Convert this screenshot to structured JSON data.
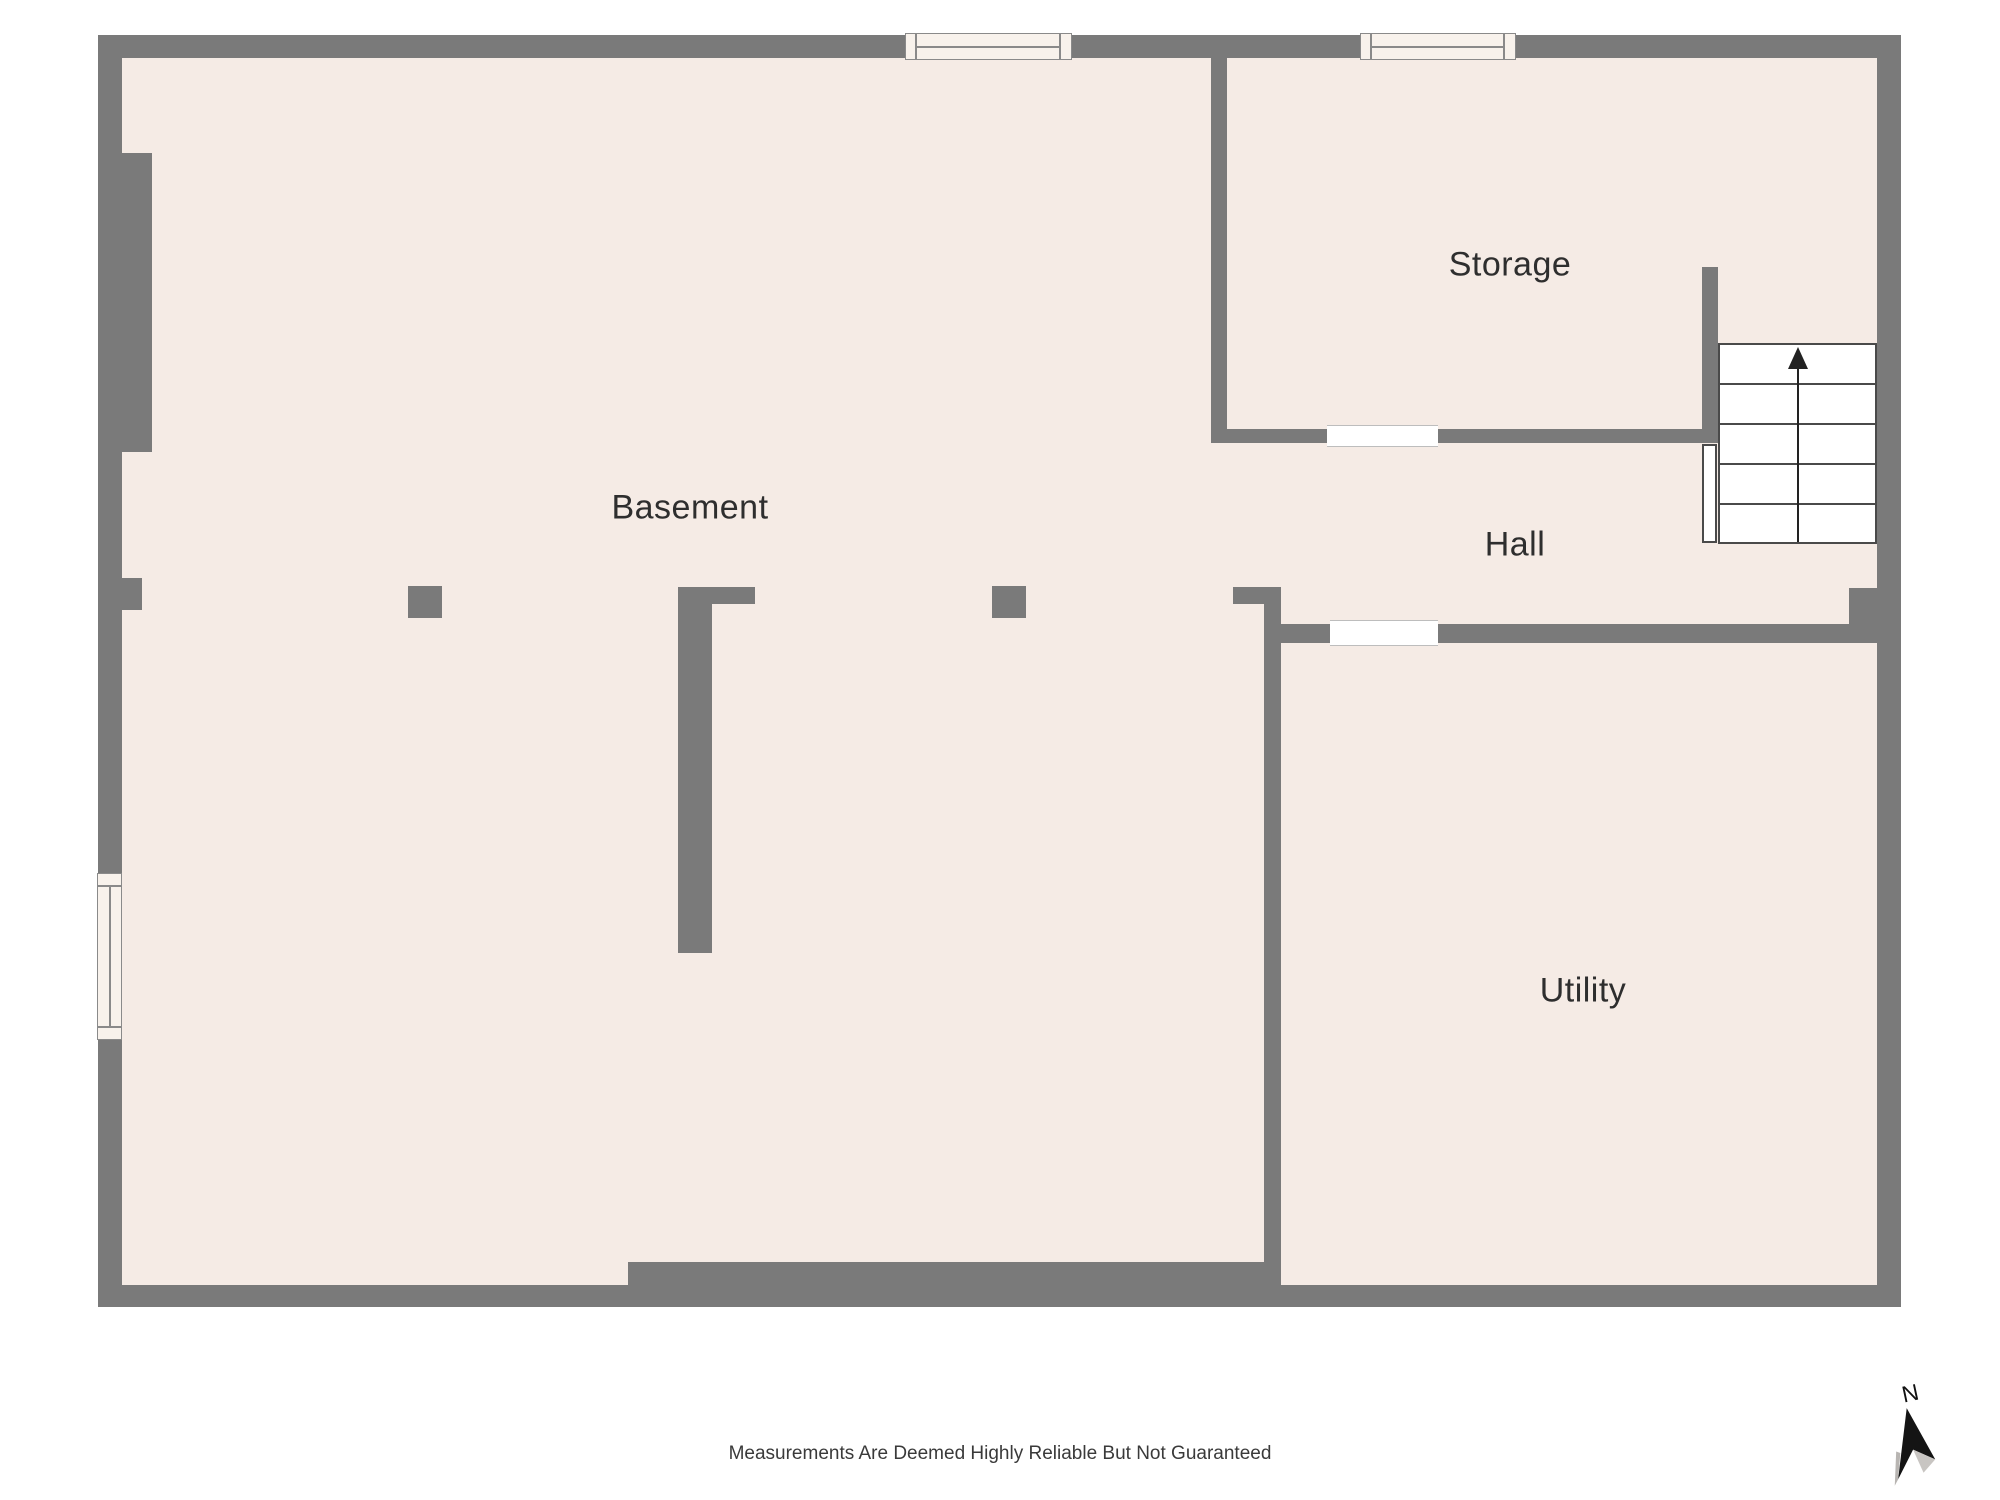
{
  "floorplan": {
    "rooms": [
      {
        "label": "Basement"
      },
      {
        "label": "Storage"
      },
      {
        "label": "Hall"
      },
      {
        "label": "Utility"
      }
    ],
    "compass": {
      "north_label": "N"
    },
    "footer": {
      "disclaimer": "Measurements Are Deemed Highly Reliable But Not Guaranteed"
    },
    "colors": {
      "background": "#ffffff",
      "wall": "#7a7a7a",
      "floor": "#f5ebe5",
      "window_fill": "#f8f2ec",
      "window_border": "#8a8a8a",
      "door_gap": "#ffffff",
      "stair_line": "#4a4a4a",
      "text": "#2e2e2e",
      "footer_text": "#3a3a3a"
    }
  }
}
